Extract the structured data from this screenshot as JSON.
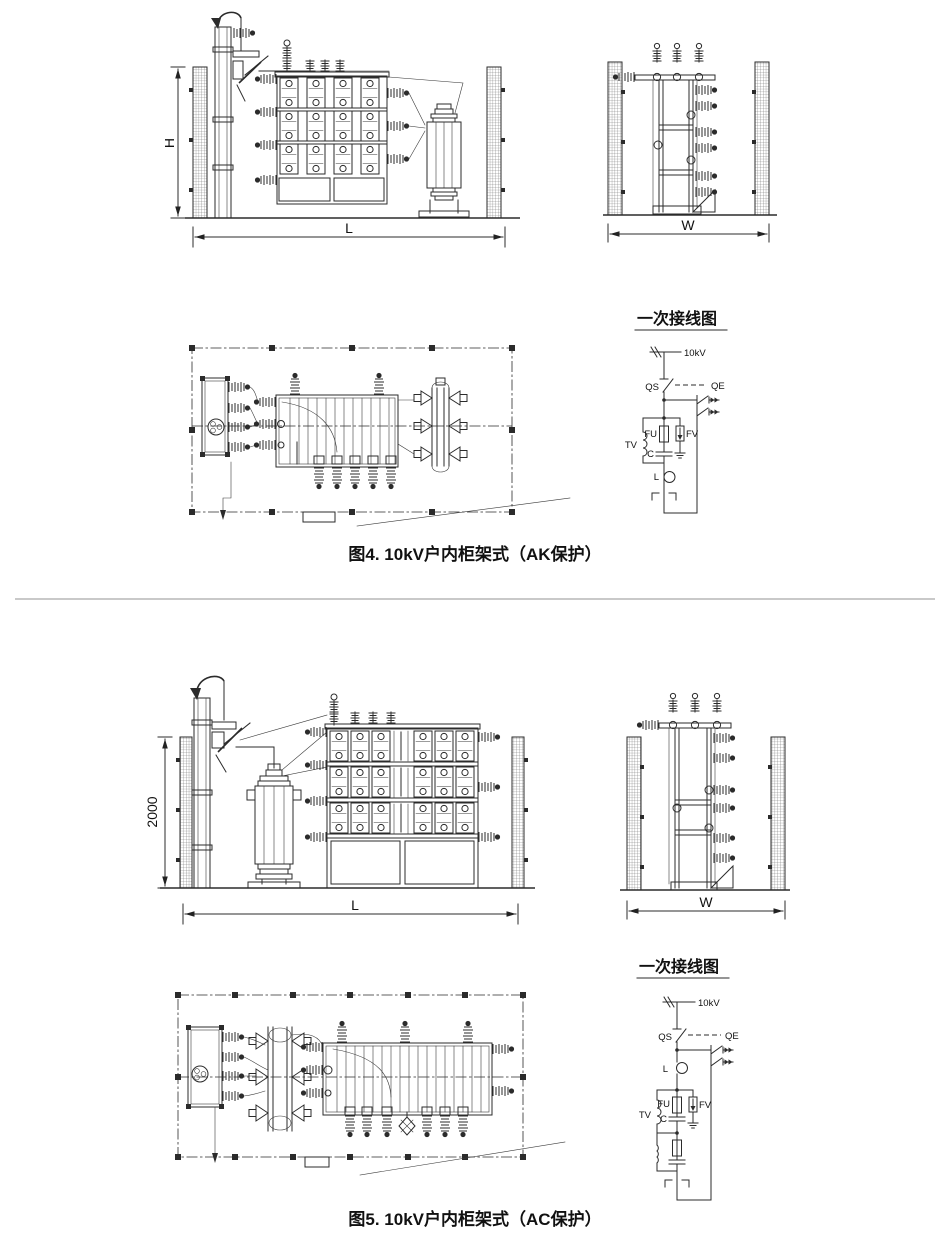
{
  "page": {
    "divider_color": "#c9c9c9"
  },
  "figure4": {
    "caption": "图4. 10kV户内柜架式（AK保护）",
    "dimensions": {
      "height": "H",
      "length": "L",
      "width": "W"
    },
    "schematic": {
      "title": "一次接线图",
      "labels": {
        "bus": "10kV",
        "disconnector": "QS",
        "earthing_switch": "QE",
        "voltage_transformer": "TV",
        "fuse": "FU",
        "capacitor": "C",
        "arrester": "FV",
        "reactor": "L"
      }
    }
  },
  "figure5": {
    "caption": "图5. 10kV户内柜架式（AC保护）",
    "dimensions": {
      "height": "2000",
      "length": "L",
      "width": "W"
    },
    "schematic": {
      "title": "一次接线图",
      "labels": {
        "bus": "10kV",
        "disconnector": "QS",
        "earthing_switch": "QE",
        "voltage_transformer": "TV",
        "fuse": "FU",
        "capacitor": "C",
        "arrester": "FV",
        "reactor": "L"
      }
    }
  }
}
